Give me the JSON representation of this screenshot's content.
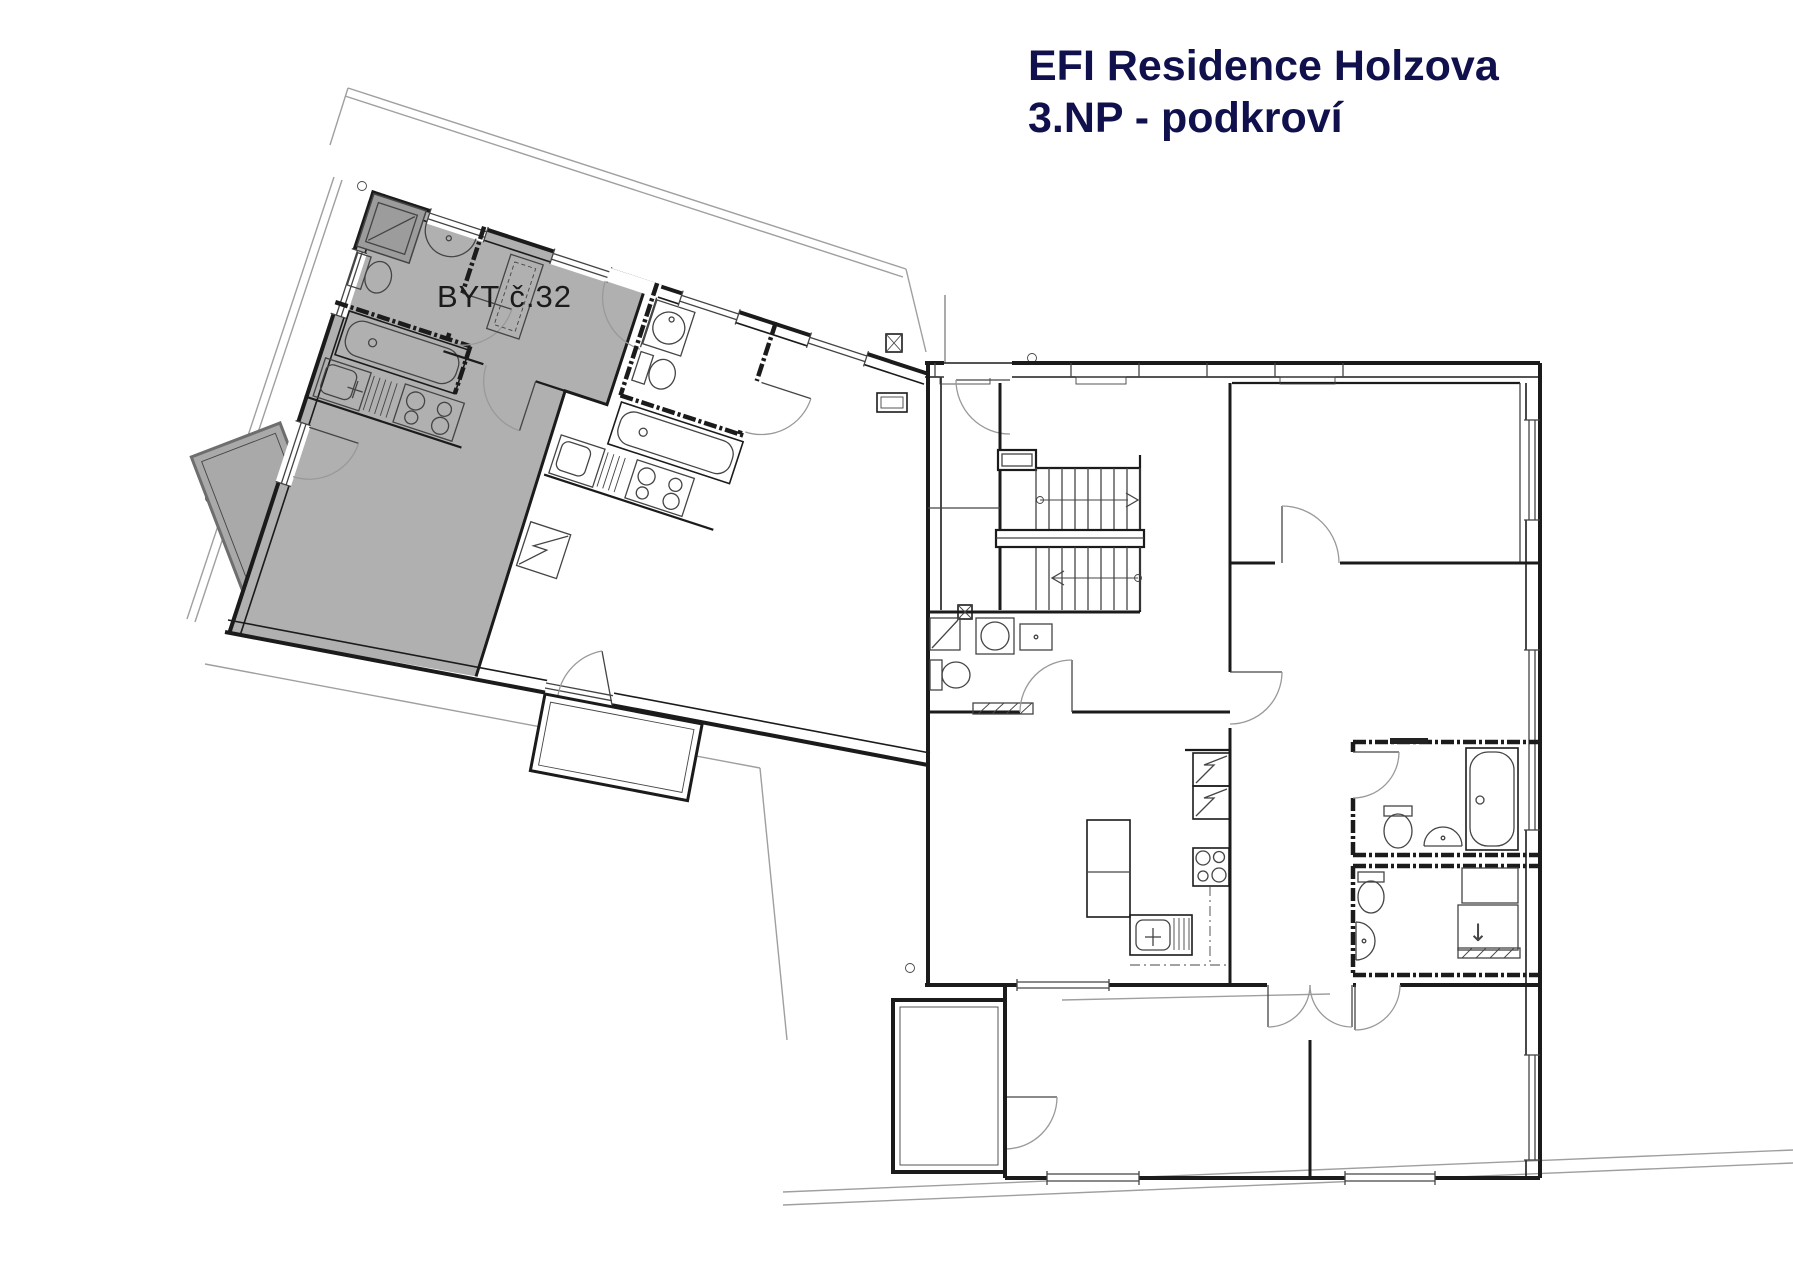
{
  "title": {
    "line1": "EFI Residence Holzova",
    "line2": "3.NP - podkroví"
  },
  "plan": {
    "highlighted_unit_label": "BYT č.32",
    "shower_arrow": "↓",
    "colors": {
      "title_color": "#10104d",
      "highlight_fill": "#b0b0b0",
      "balcony_fill": "#a9a9a9",
      "shower_fill": "#9c9c9c",
      "wall_color": "#1b1b1b",
      "line_color": "#444444",
      "door_arc_color": "#999999",
      "eaves_color": "#9f9f9f",
      "background": "#ffffff"
    }
  }
}
